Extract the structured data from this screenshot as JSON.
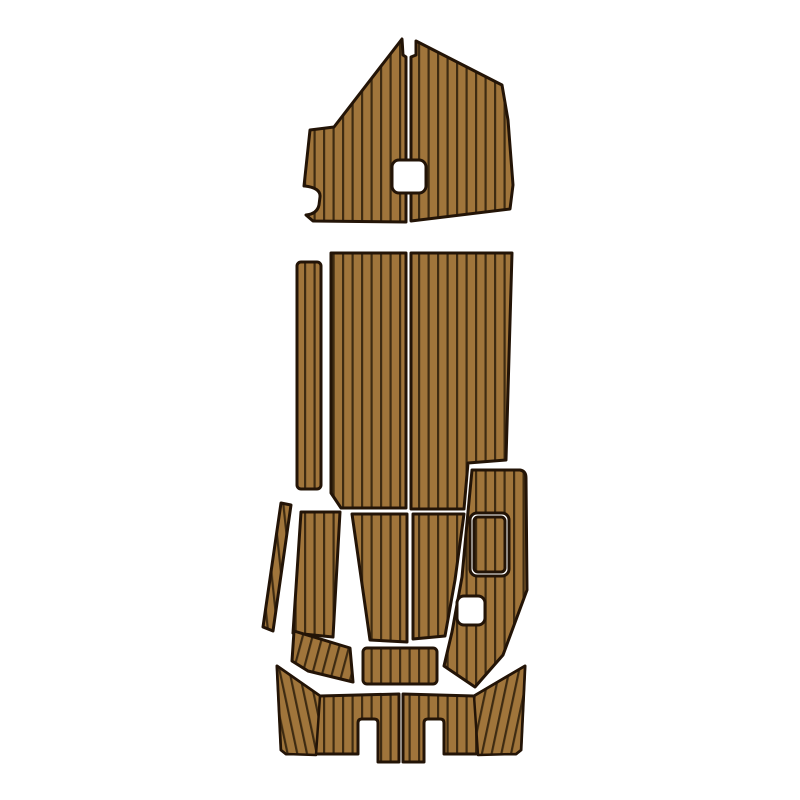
{
  "image": {
    "kind": "product-photo",
    "subject": "EVA foam faux-teak boat deck pad set, top view, arranged as boat layout on white background",
    "width": 800,
    "height": 800
  },
  "colors": {
    "background": "#ffffff",
    "plank_fill": "#a0753b",
    "plank_line": "#3e2b12",
    "outline": "#231407",
    "cutout_fill": "#ffffff"
  },
  "stripe": {
    "spacing": 9.5,
    "line_width": 2.2,
    "tile_height": 10,
    "outline_width": 3,
    "overlay_outline_width": 2.5,
    "rotations": {
      "p0": 0,
      "pL": -12,
      "pR": 12,
      "pS": 15,
      "pT": -6
    }
  },
  "pieces": [
    {
      "name": "bow-pad-left-half",
      "kind": "path",
      "fill": "planks",
      "pattern": "p0",
      "d": "M 402,39 L 403,55 L 406,57 L 406,222 L 313,221 L 306,215 Q 317,214 319,205 L 320,197 Q 321,188 305,186 L 304,186 L 310,130 L 334,127 Z"
    },
    {
      "name": "bow-pad-right-half",
      "kind": "path",
      "fill": "planks",
      "pattern": "p0",
      "d": "M 416,41 L 502,85 L 508,120 L 513,185 L 510,209 L 411,221 L 411,57 L 416,55 Z"
    },
    {
      "name": "bow-pad-hatch-hole",
      "kind": "rect",
      "fill": "cutout",
      "x": 392,
      "y": 160,
      "w": 34,
      "h": 33,
      "rx": 7
    },
    {
      "name": "mid-port-runner-pad",
      "kind": "rect",
      "fill": "planks",
      "pattern": "p0",
      "x": 297,
      "y": 262,
      "w": 24,
      "h": 227,
      "rx": 4
    },
    {
      "name": "main-deck-left-half",
      "kind": "path",
      "fill": "planks",
      "pattern": "p0",
      "d": "M 331,253 L 406,253 L 406,508 L 341,508 L 331,493 Z"
    },
    {
      "name": "main-deck-right-half",
      "kind": "path",
      "fill": "planks",
      "pattern": "p0",
      "d": "M 411,253 L 512,253 L 506,460 L 468,463 L 464,509 L 411,509 Z"
    },
    {
      "name": "cockpit-port-gunwale-strip",
      "kind": "path",
      "fill": "planks",
      "pattern": "pT",
      "d": "M 281,503 L 291,505 L 273,631 L 263,627 Z"
    },
    {
      "name": "cockpit-port-side-pad",
      "kind": "path",
      "fill": "planks",
      "pattern": "p0",
      "d": "M 301,512 L 340,512 L 333,637 L 293,633 Z"
    },
    {
      "name": "cockpit-port-lower-pad",
      "kind": "path",
      "fill": "planks",
      "pattern": "pS",
      "d": "M 294,631 L 350,648 L 353,682 L 308,671 L 292,661 Z"
    },
    {
      "name": "cockpit-center-left-pad",
      "kind": "path",
      "fill": "planks",
      "pattern": "p0",
      "d": "M 352,514 L 407,514 L 407,642 L 370,640 Z"
    },
    {
      "name": "cockpit-center-right-pad",
      "kind": "path",
      "fill": "planks",
      "pattern": "p0",
      "d": "M 413,514 L 464,514 L 455,580 L 445,636 L 413,639 Z"
    },
    {
      "name": "cockpit-starboard-side-pad",
      "kind": "path",
      "fill": "planks",
      "pattern": "p0",
      "d": "M 472,470 L 520,470 Q 526,471 526,478 L 527,590 L 503,655 L 475,687 L 444,666 L 452,632 L 462,577 L 468,512 Z"
    },
    {
      "name": "starboard-hatch-cutout",
      "kind": "rect",
      "fill": "cutout",
      "x": 470,
      "y": 513,
      "w": 39,
      "h": 63,
      "rx": 7
    },
    {
      "name": "starboard-hatch-pad",
      "kind": "rect",
      "fill": "planks",
      "pattern": "p0",
      "x": 474,
      "y": 517,
      "w": 31,
      "h": 55,
      "rx": 4
    },
    {
      "name": "starboard-notch-cutout",
      "kind": "rect",
      "fill": "cutout",
      "x": 457,
      "y": 596,
      "w": 28,
      "h": 29,
      "rx": 7
    },
    {
      "name": "transom-center-pad",
      "kind": "rect",
      "fill": "planks",
      "pattern": "p0",
      "x": 363,
      "y": 648,
      "w": 74,
      "h": 36,
      "rx": 4
    },
    {
      "name": "swim-platform-left-half",
      "kind": "path",
      "fill": "planks",
      "pattern": "p0",
      "d": "M 277,666 L 320,696 L 399,694 L 399,762 L 378,762 L 378,723 Q 378,719 374,719 L 362,719 Q 358,719 358,723 L 358,754 L 286,754 L 281,750 Z"
    },
    {
      "name": "swim-platform-left-wing",
      "kind": "path",
      "fill": "planks",
      "pattern": "pL",
      "overlay": true,
      "d": "M 277,666 L 320,696 L 316,755 L 286,754 L 281,750 Z"
    },
    {
      "name": "swim-platform-right-half",
      "kind": "path",
      "fill": "planks",
      "pattern": "p0",
      "d": "M 525,666 L 474,696 L 403,694 L 403,762 L 424,762 L 424,723 Q 424,719 428,719 L 440,719 Q 444,719 444,723 L 444,754 L 516,754 L 521,750 Z"
    },
    {
      "name": "swim-platform-right-wing",
      "kind": "path",
      "fill": "planks",
      "pattern": "pR",
      "overlay": true,
      "d": "M 525,666 L 474,696 L 478,755 L 516,754 L 521,750 Z"
    }
  ]
}
